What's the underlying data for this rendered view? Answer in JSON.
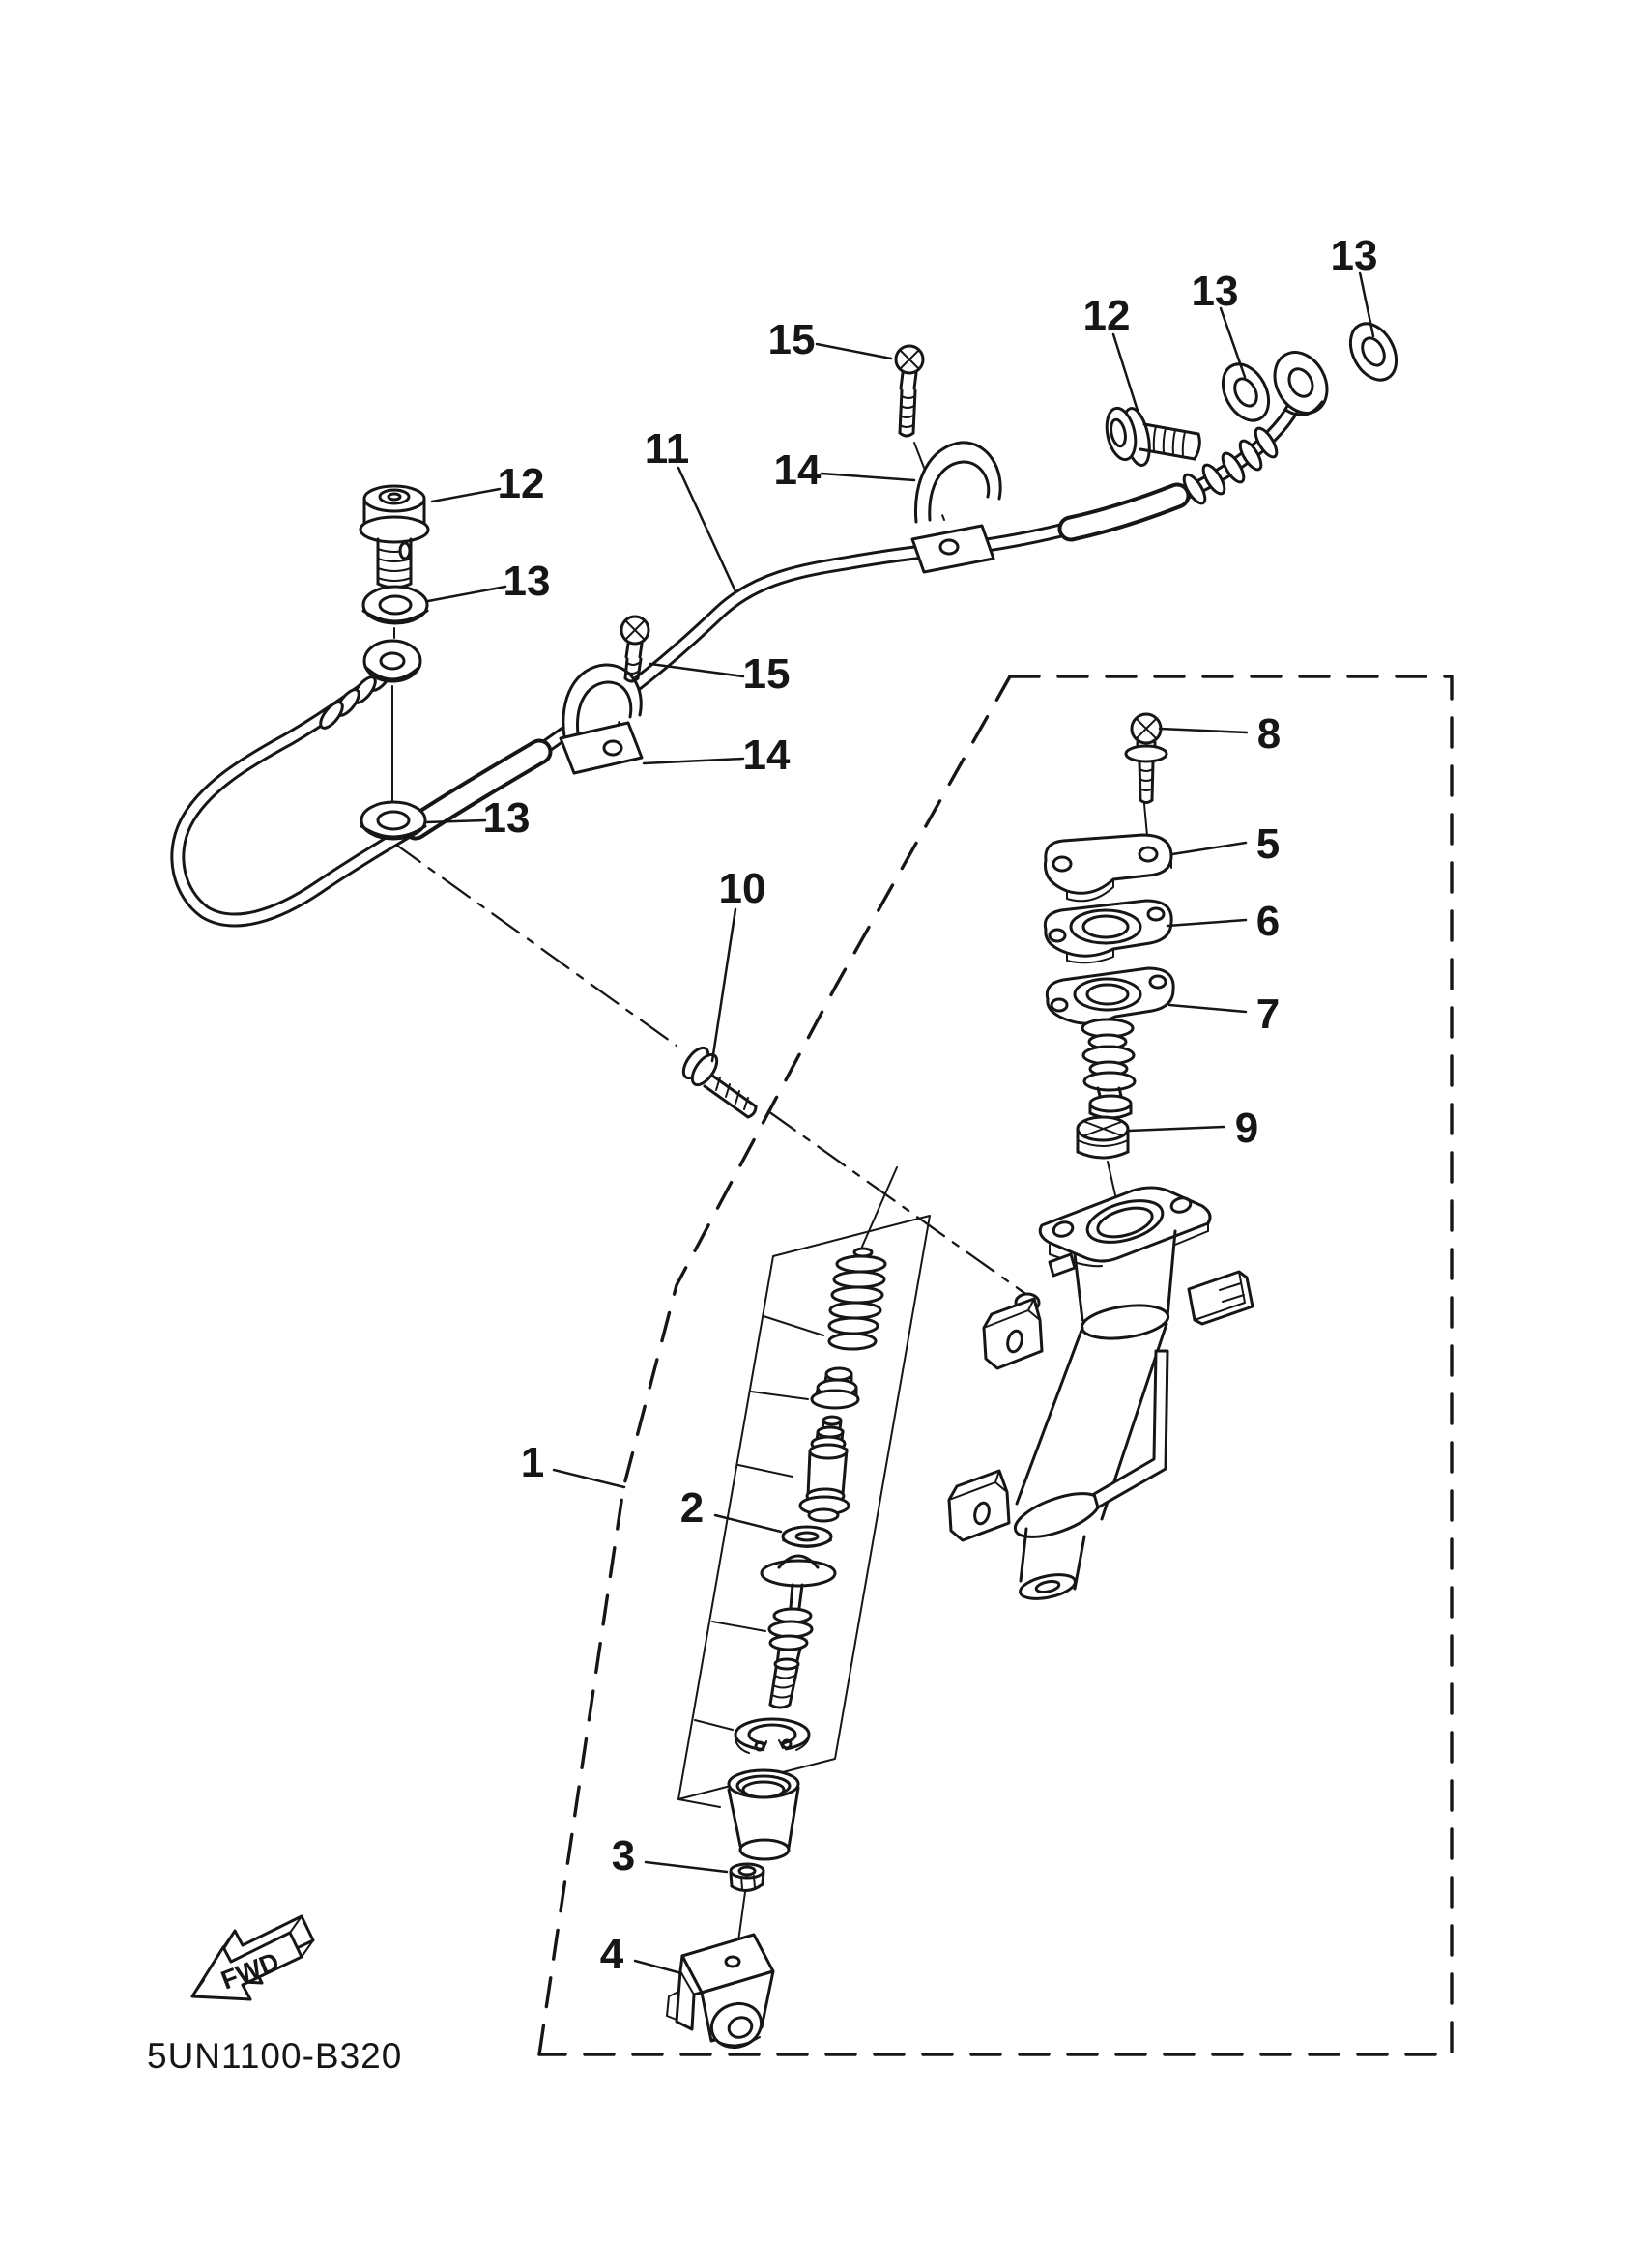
{
  "page": {
    "background": "#ffffff",
    "line_color": "#161616"
  },
  "diagram": {
    "code": "5UN1100-B320",
    "fwd_label": "FWD",
    "callouts": [
      {
        "label": "1"
      },
      {
        "label": "2"
      },
      {
        "label": "3"
      },
      {
        "label": "4"
      },
      {
        "label": "5"
      },
      {
        "label": "6"
      },
      {
        "label": "7"
      },
      {
        "label": "8"
      },
      {
        "label": "9"
      },
      {
        "label": "10"
      },
      {
        "label": "11"
      },
      {
        "label": "12"
      },
      {
        "label": "12"
      },
      {
        "label": "13"
      },
      {
        "label": "13"
      },
      {
        "label": "13"
      },
      {
        "label": "13"
      },
      {
        "label": "14"
      },
      {
        "label": "14"
      },
      {
        "label": "15"
      },
      {
        "label": "15"
      }
    ]
  }
}
